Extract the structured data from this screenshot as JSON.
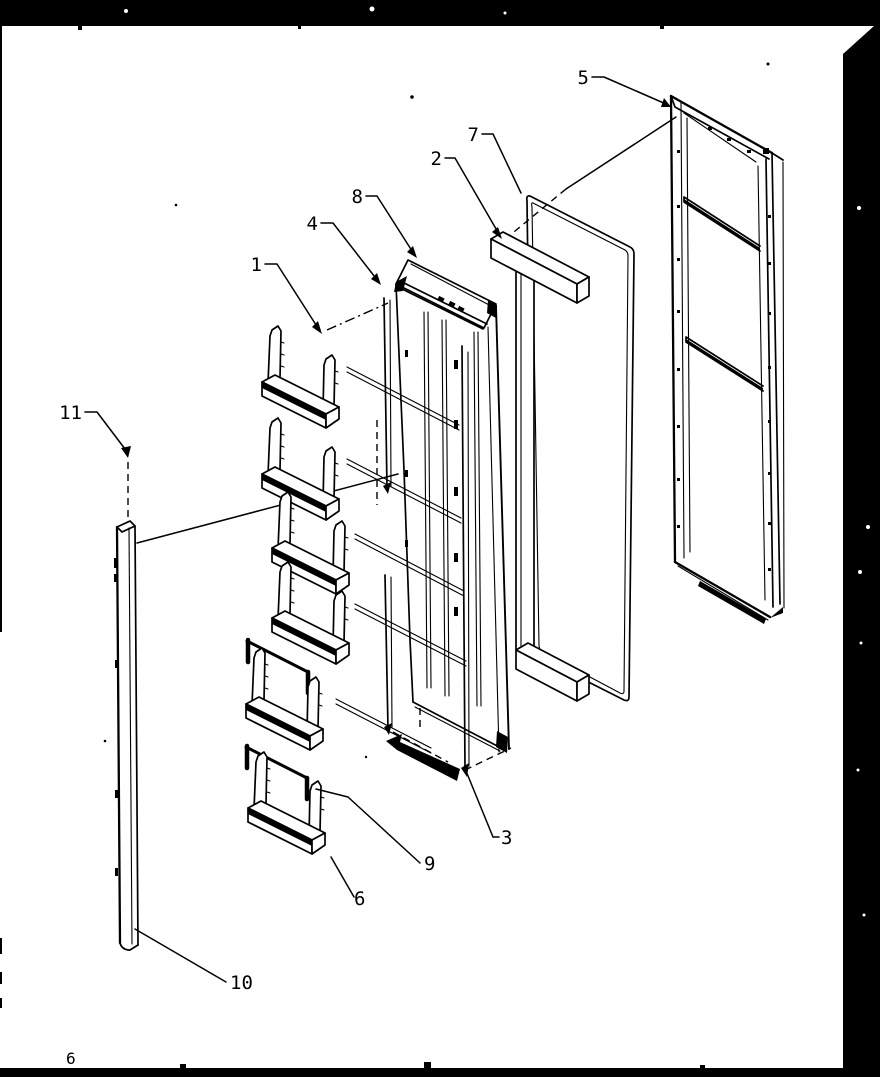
{
  "page": {
    "background": "#ffffff",
    "ink": "#000000",
    "frame_color": "#000000",
    "footer_mark": "6"
  },
  "diagram": {
    "description": "Exploded view parts diagram of a refrigerator door assembly with door bins, inner door liner, handle, gasket and outer door panel",
    "callouts": {
      "c1": {
        "label": "1"
      },
      "c2": {
        "label": "2"
      },
      "c3": {
        "label": "3"
      },
      "c4": {
        "label": "4"
      },
      "c5": {
        "label": "5"
      },
      "c6": {
        "label": "6"
      },
      "c7": {
        "label": "7"
      },
      "c8": {
        "label": "8"
      },
      "c9": {
        "label": "9"
      },
      "c10": {
        "label": "10"
      },
      "c11": {
        "label": "11"
      }
    }
  }
}
